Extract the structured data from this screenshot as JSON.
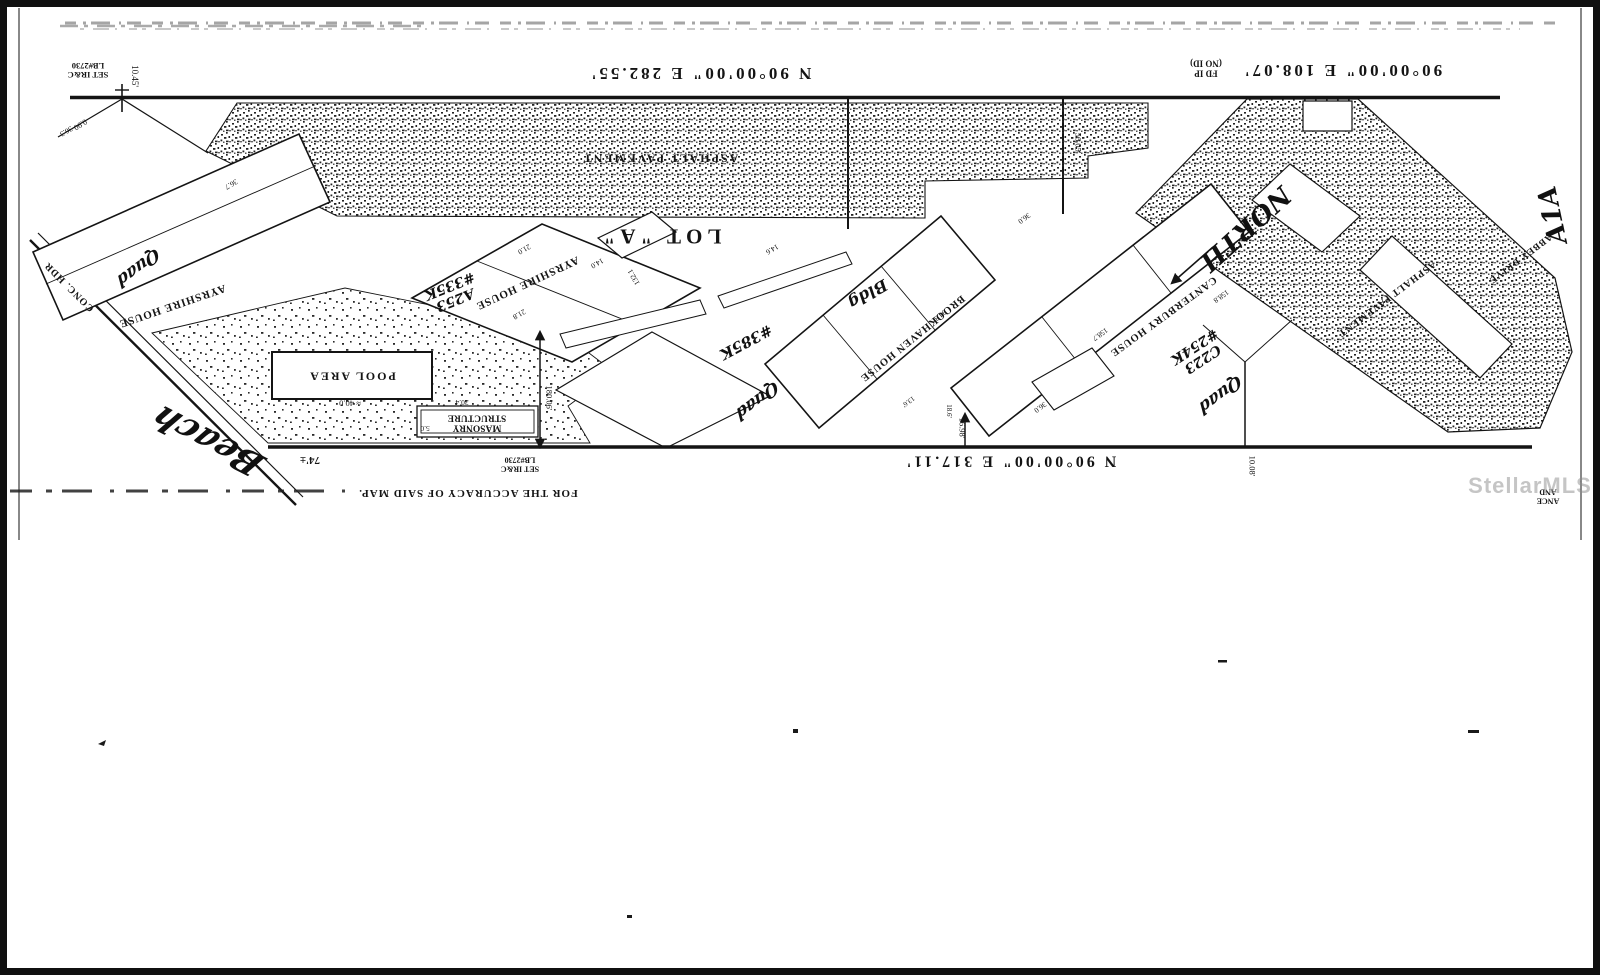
{
  "watermark": "StellarMLS",
  "colors": {
    "ink": "#141414",
    "paper": "#ffffff",
    "watermark_gray": "#8d8d8d"
  },
  "map": {
    "labels": [
      {
        "name": "bearing-north-west",
        "text": "N 90°00'00\" E  282.55'",
        "x": 700,
        "y": 73,
        "rot": 180,
        "size": 17,
        "cls": "srv b",
        "ls": 3
      },
      {
        "name": "bearing-north-east",
        "text": "90°00'00\" E  108.07'",
        "x": 1342,
        "y": 70,
        "rot": 180,
        "size": 17,
        "cls": "srv b",
        "ls": 3
      },
      {
        "name": "found-iron-pipe-note",
        "text": "FD IP\n(NO ID)",
        "x": 1206,
        "y": 68,
        "rot": 180,
        "size": 9,
        "cls": "srv b"
      },
      {
        "name": "set-iron-rod-note-nw",
        "text": "SET IR&C\nLB#2730",
        "x": 88,
        "y": 70,
        "rot": 180,
        "size": 8.5,
        "cls": "srv b"
      },
      {
        "name": "dim-10-45",
        "text": "10.45'",
        "x": 134,
        "y": 76,
        "rot": 90,
        "size": 9,
        "cls": "srv"
      },
      {
        "name": "dim-0-90",
        "text": "0.90",
        "x": 80,
        "y": 124,
        "rot": 148,
        "size": 8,
        "cls": "srv"
      },
      {
        "name": "asphalt-pavement-label-top",
        "text": "ASPHALT PAVEMENT",
        "x": 660,
        "y": 158,
        "rot": 180,
        "size": 12,
        "cls": "srv b",
        "ls": 2
      },
      {
        "name": "lot-a-label",
        "text": "LOT \"A\"",
        "x": 660,
        "y": 236,
        "rot": 180,
        "size": 21,
        "cls": "srv b",
        "ls": 5
      },
      {
        "name": "ayrshire-house-west-label",
        "text": "AYRSHIRE HOUSE",
        "x": 172,
        "y": 305,
        "rot": 161,
        "size": 11,
        "cls": "srv b",
        "ls": 1
      },
      {
        "name": "ayrshire-house-label",
        "text": "AYRSHIRE HOUSE",
        "x": 527,
        "y": 282,
        "rot": 155,
        "size": 11,
        "cls": "srv b",
        "ls": 1
      },
      {
        "name": "hw-a253-335k",
        "text": "A253\n#335K",
        "x": 452,
        "y": 292,
        "rot": 158,
        "size": 14,
        "cls": "hw"
      },
      {
        "name": "brookhaven-house-label",
        "text": "BROOKHAVEN HOUSE",
        "x": 912,
        "y": 338,
        "rot": 141,
        "size": 10.5,
        "cls": "srv b",
        "ls": 1
      },
      {
        "name": "hw-bldg",
        "text": "Bldg",
        "x": 868,
        "y": 294,
        "rot": 150,
        "size": 16,
        "cls": "hw"
      },
      {
        "name": "hw-385k",
        "text": "#385K",
        "x": 746,
        "y": 342,
        "rot": 152,
        "size": 15,
        "cls": "hw"
      },
      {
        "name": "canterbury-house-label",
        "text": "CANTERBURY HOUSE",
        "x": 1163,
        "y": 316,
        "rot": 144,
        "size": 10.5,
        "cls": "srv b",
        "ls": 1
      },
      {
        "name": "hw-c223-254k",
        "text": "C223\n#254K",
        "x": 1198,
        "y": 352,
        "rot": 147,
        "size": 14,
        "cls": "hw"
      },
      {
        "name": "hw-quad-west",
        "text": "Quad",
        "x": 138,
        "y": 267,
        "rot": 143,
        "size": 17,
        "cls": "hw cur"
      },
      {
        "name": "hw-quad-center",
        "text": "Quad",
        "x": 757,
        "y": 400,
        "rot": 143,
        "size": 17,
        "cls": "hw cur"
      },
      {
        "name": "hw-quad-east",
        "text": "Quad",
        "x": 1220,
        "y": 394,
        "rot": 143,
        "size": 17,
        "cls": "hw cur"
      },
      {
        "name": "pool-area-label",
        "text": "POOL AREA",
        "x": 352,
        "y": 376,
        "rot": 180,
        "size": 12,
        "cls": "srv b",
        "ls": 2
      },
      {
        "name": "dim-40-0",
        "text": "≈ 40.0",
        "x": 350,
        "y": 403,
        "rot": 180,
        "size": 8.5,
        "cls": "srv"
      },
      {
        "name": "masonry-structure-label",
        "text": "MASONRY\nSTRUCTURE",
        "x": 477,
        "y": 422,
        "rot": 180,
        "size": 9.5,
        "cls": "srv b"
      },
      {
        "name": "dim-30-4",
        "text": "30.4",
        "x": 462,
        "y": 402,
        "rot": 180,
        "size": 7.5,
        "cls": "srv"
      },
      {
        "name": "dim-5-0",
        "text": "5.0",
        "x": 425,
        "y": 428,
        "rot": 180,
        "size": 7.5,
        "cls": "srv"
      },
      {
        "name": "dim-74",
        "text": "74'±",
        "x": 310,
        "y": 459,
        "rot": 180,
        "size": 11,
        "cls": "srv b"
      },
      {
        "name": "set-iron-rod-note-s",
        "text": "SET IR&C\nLB#2730",
        "x": 520,
        "y": 464,
        "rot": 180,
        "size": 8,
        "cls": "srv b"
      },
      {
        "name": "bearing-south",
        "text": "N 90°00'00\" E  317.11'",
        "x": 1010,
        "y": 461,
        "rot": 180,
        "size": 16,
        "cls": "srv b",
        "ls": 3
      },
      {
        "name": "dim-16-98",
        "text": "16.98'",
        "x": 962,
        "y": 428,
        "rot": 90,
        "size": 8.5,
        "cls": "srv"
      },
      {
        "name": "dim-10-08",
        "text": "10.08'",
        "x": 1252,
        "y": 466,
        "rot": 90,
        "size": 8.5,
        "cls": "srv"
      },
      {
        "name": "dim-180-06",
        "text": "180.06'",
        "x": 549,
        "y": 398,
        "rot": 90,
        "size": 8.5,
        "cls": "srv"
      },
      {
        "name": "dim-56-05",
        "text": "56.05'",
        "x": 1078,
        "y": 143,
        "rot": 90,
        "size": 8.5,
        "cls": "srv"
      },
      {
        "name": "conc-hdr-label",
        "text": "CONC. HDR",
        "x": 70,
        "y": 286,
        "rot": 225,
        "size": 10,
        "cls": "srv b",
        "ls": 1
      },
      {
        "name": "hw-beach",
        "text": "Beach",
        "x": 208,
        "y": 440,
        "rot": 207,
        "size": 34,
        "cls": "hw cur"
      },
      {
        "name": "hw-north",
        "text": "NORTH",
        "x": 1245,
        "y": 228,
        "rot": 138,
        "size": 26,
        "cls": "hw"
      },
      {
        "name": "hw-a1a",
        "text": "A1A",
        "x": 1553,
        "y": 215,
        "rot": 258,
        "size": 26,
        "cls": "hw"
      },
      {
        "name": "abbey-drive-label",
        "text": "ABBEY DRIVE",
        "x": 1520,
        "y": 258,
        "rot": 143,
        "size": 9.5,
        "cls": "srv b",
        "ls": 1
      },
      {
        "name": "asphalt-pavement-label-east",
        "text": "ASPHALT PAVEMENT",
        "x": 1386,
        "y": 298,
        "rot": 143,
        "size": 10,
        "cls": "srv b",
        "ls": 1
      },
      {
        "name": "accuracy-note",
        "text": "FOR THE ACCURACY OF SAID MAP.",
        "x": 468,
        "y": 492,
        "rot": 180,
        "size": 11,
        "cls": "srv b",
        "ls": 1
      },
      {
        "name": "corner-fragment",
        "text": "ANCE\nAND",
        "x": 1548,
        "y": 496,
        "rot": 180,
        "size": 8,
        "cls": "srv b"
      },
      {
        "name": "dim-36-3",
        "text": "36.3",
        "x": 66,
        "y": 131,
        "rot": 150,
        "size": 7.5,
        "cls": "srv"
      },
      {
        "name": "dim-36-7",
        "text": "36.7",
        "x": 231,
        "y": 184,
        "rot": 150,
        "size": 7.5,
        "cls": "srv"
      },
      {
        "name": "dim-21-0",
        "text": "21.0",
        "x": 524,
        "y": 249,
        "rot": 150,
        "size": 7.5,
        "cls": "srv"
      },
      {
        "name": "dim-14-0",
        "text": "14.0",
        "x": 597,
        "y": 263,
        "rot": 150,
        "size": 7.5,
        "cls": "srv"
      },
      {
        "name": "dim-21-8",
        "text": "21.8",
        "x": 519,
        "y": 314,
        "rot": 150,
        "size": 7.5,
        "cls": "srv"
      },
      {
        "name": "dim-132-1",
        "text": "132.1",
        "x": 634,
        "y": 277,
        "rot": 240,
        "size": 7.5,
        "cls": "srv"
      },
      {
        "name": "dim-14-6",
        "text": "14.6",
        "x": 772,
        "y": 249,
        "rot": 150,
        "size": 7.5,
        "cls": "srv"
      },
      {
        "name": "dim-94-3",
        "text": "94.3",
        "x": 940,
        "y": 315,
        "rot": 141,
        "size": 7.5,
        "cls": "srv"
      },
      {
        "name": "dim-36-0-n",
        "text": "36.0",
        "x": 1024,
        "y": 218,
        "rot": 144,
        "size": 7.5,
        "cls": "srv"
      },
      {
        "name": "dim-158-7",
        "text": "158.7",
        "x": 1100,
        "y": 334,
        "rot": 144,
        "size": 7.5,
        "cls": "srv"
      },
      {
        "name": "dim-158-8",
        "text": "158.8",
        "x": 1221,
        "y": 296,
        "rot": 144,
        "size": 7.5,
        "cls": "srv"
      },
      {
        "name": "dim-36-0-s",
        "text": "36.0",
        "x": 1040,
        "y": 407,
        "rot": 144,
        "size": 7.5,
        "cls": "srv"
      },
      {
        "name": "dim-18-6",
        "text": "18.6'",
        "x": 948,
        "y": 411,
        "rot": 90,
        "size": 7,
        "cls": "srv"
      },
      {
        "name": "dim-13-6",
        "text": "13.6'",
        "x": 908,
        "y": 401,
        "rot": 144,
        "size": 7,
        "cls": "srv"
      },
      {
        "name": "mls-watermark",
        "text": "StellarMLS",
        "x": 1530,
        "y": 486,
        "rot": 0,
        "size": 22,
        "cls": "wm"
      }
    ]
  }
}
